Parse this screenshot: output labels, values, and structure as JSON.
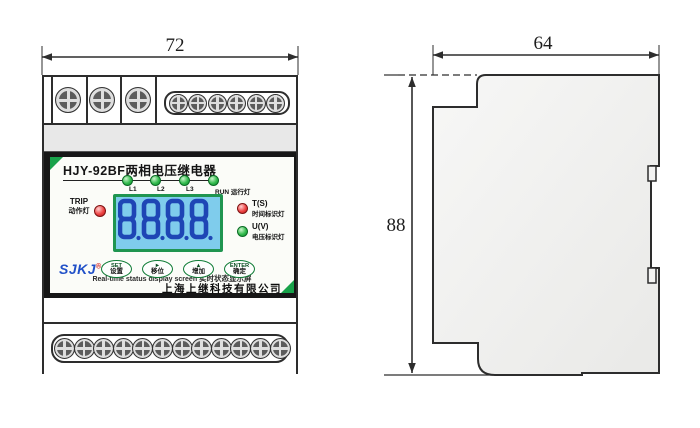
{
  "diagram": {
    "front_view": {
      "width_dim": "72",
      "panel": {
        "title": "HJY-92BF两相电压继电器",
        "phase_leds": [
          {
            "label": "L1",
            "color": "green"
          },
          {
            "label": "L2",
            "color": "green"
          },
          {
            "label": "L3",
            "color": "green"
          },
          {
            "label": "RUN 运行灯",
            "color": "green"
          }
        ],
        "trip_led": {
          "label_en": "TRIP",
          "label_zh": "动作灯",
          "color": "red"
        },
        "lcd": {
          "digits": "8888",
          "decimal_points": true
        },
        "status_leds": [
          {
            "label_en": "T(S)",
            "label_zh": "时间标识灯",
            "color": "red"
          },
          {
            "label_en": "U(V)",
            "label_zh": "电压标识灯",
            "color": "green"
          }
        ],
        "caption_en": "Real-time status display screen",
        "caption_zh": "实时状态显示屏",
        "logo_text": "SJKJ",
        "logo_reg": "®",
        "buttons": [
          {
            "name": "set-button",
            "label_en": "SET",
            "label_zh": "设置"
          },
          {
            "name": "shift-button",
            "label_en": "►",
            "label_zh": "移位"
          },
          {
            "name": "increase-button",
            "label_en": "▲",
            "label_zh": "增加"
          },
          {
            "name": "enter-button",
            "label_en": "ENTER",
            "label_zh": "确定"
          }
        ],
        "company": "上海上继科技有限公司"
      },
      "terminals": {
        "top_single_count": 3,
        "top_block_count": 6,
        "bottom_count": 12
      }
    },
    "side_view": {
      "width_dim": "64",
      "height_dim": "88"
    }
  },
  "colors": {
    "led_green": "#2eb84e",
    "led_red": "#e43b3b",
    "lcd_bg": "#7fccec",
    "lcd_digit": "#1e46b5",
    "lcd_border": "#1f9550",
    "accent_green": "#18a24a",
    "logo_blue": "#2050c8",
    "button_green": "#0f7c36"
  }
}
